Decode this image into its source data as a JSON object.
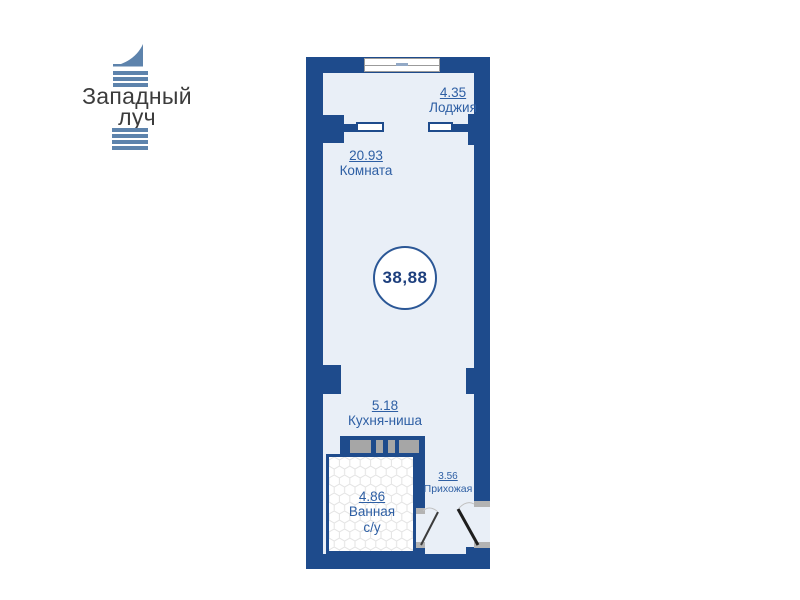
{
  "logo": {
    "name_line1": "Западный",
    "name_line2": "луч"
  },
  "floor_plan": {
    "total_area_label": "38,88",
    "rooms": [
      {
        "key": "loggia",
        "area": "4.35",
        "name": "Лоджия"
      },
      {
        "key": "room",
        "area": "20.93",
        "name": "Комната"
      },
      {
        "key": "kitchen_niche",
        "area": "5.18",
        "name": "Кухня-ниша"
      },
      {
        "key": "bathroom",
        "area": "4.86",
        "name": "Ванная",
        "name_line2": "с/у"
      },
      {
        "key": "hallway",
        "area": "3.56",
        "name": "Прихожая"
      }
    ],
    "colors": {
      "wall": "#1e4b8c",
      "floor": "#e9eff7",
      "label_text": "#2e5fa4",
      "logo_accent": "#5d83ac",
      "shaft_gray": "#a6a6a6"
    }
  }
}
